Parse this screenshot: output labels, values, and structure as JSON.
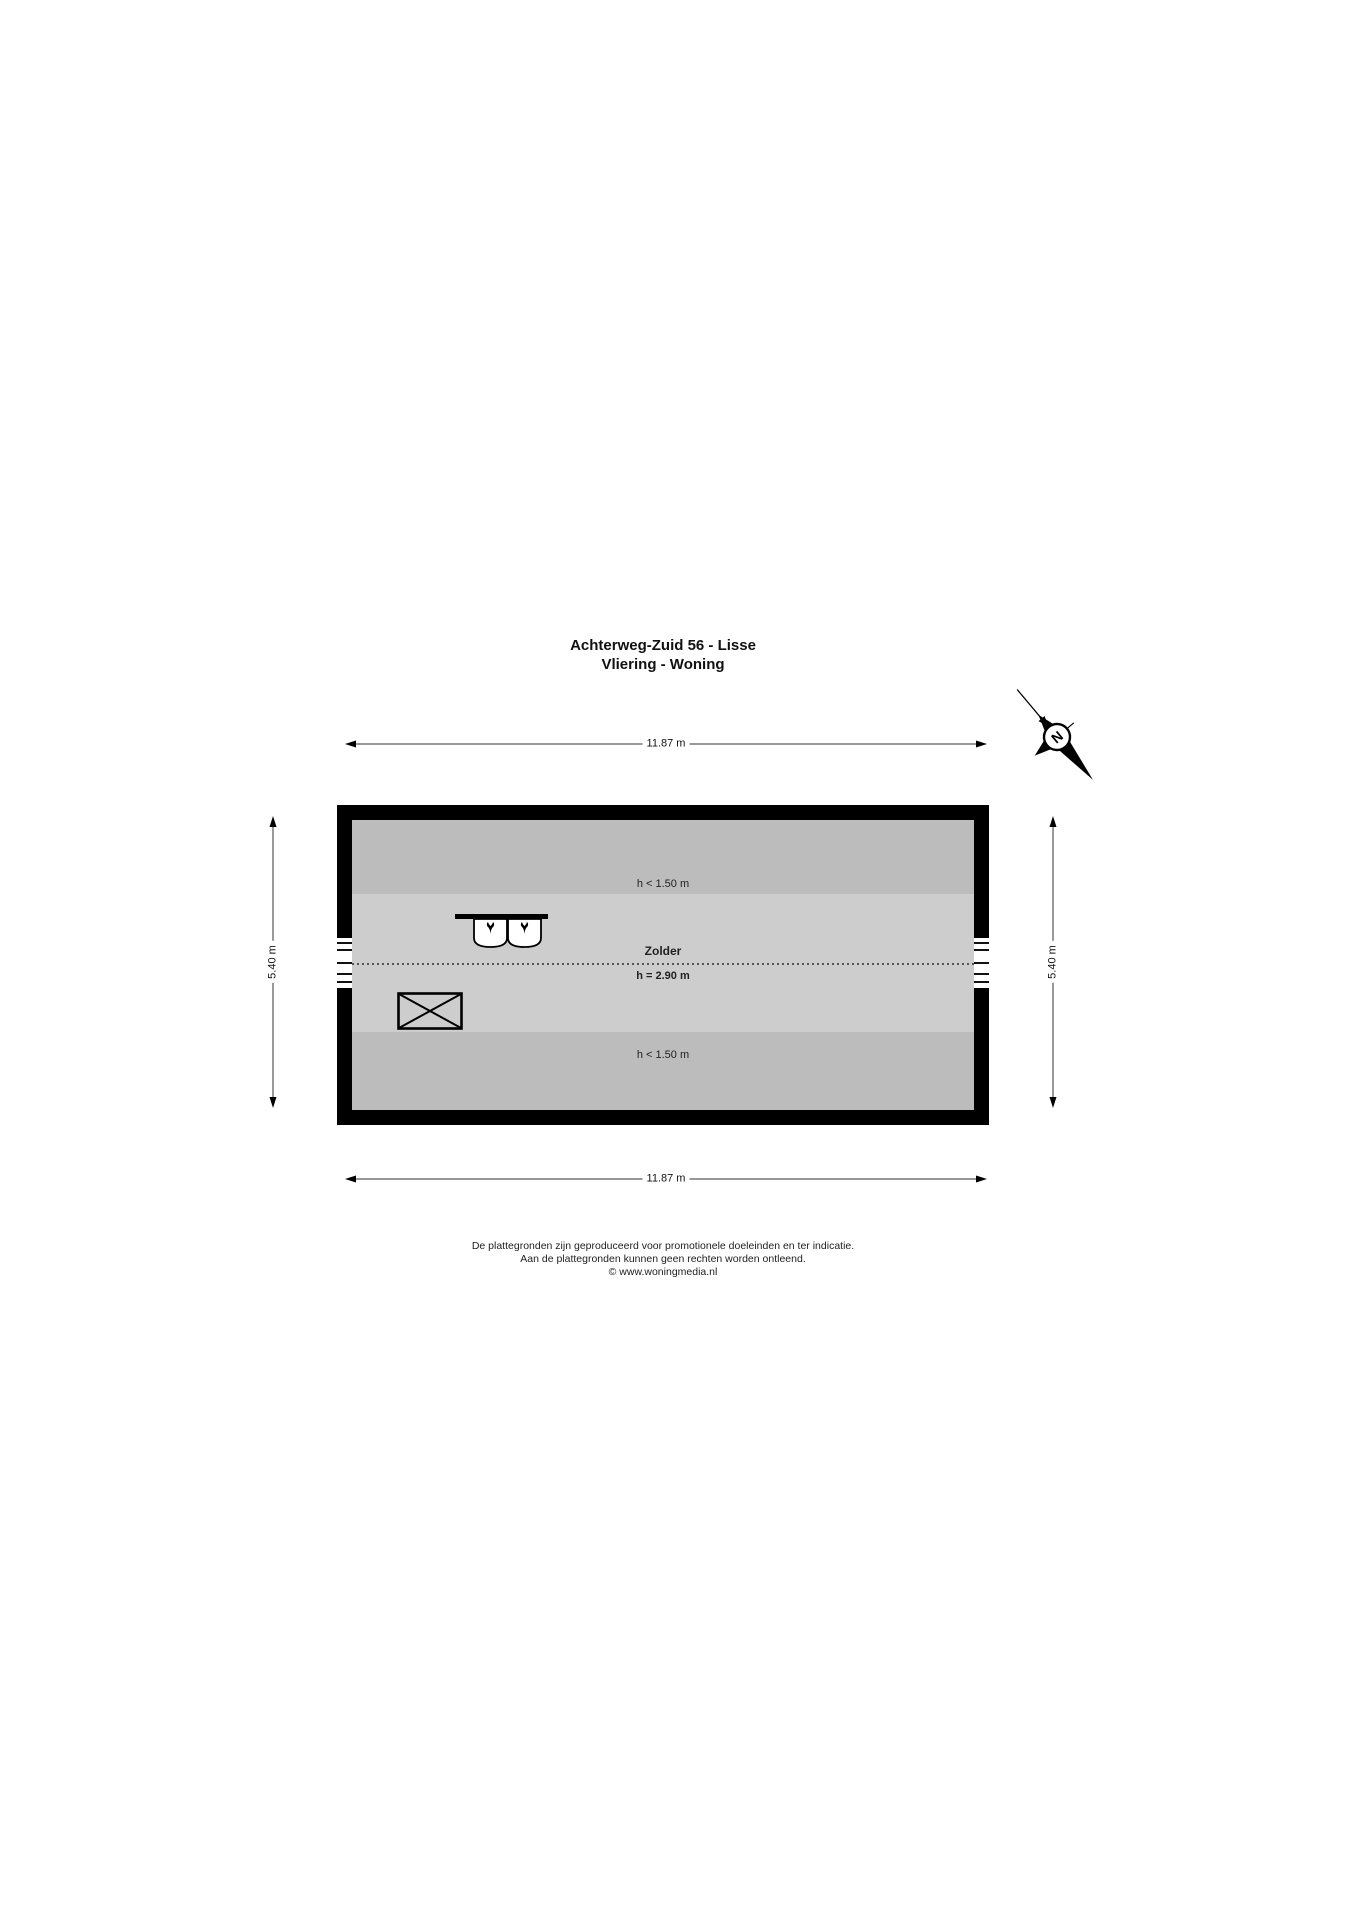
{
  "title": {
    "line1": "Achterweg-Zuid 56 - Lisse",
    "line2": "Vliering - Woning"
  },
  "compass": {
    "label": "N"
  },
  "dimensions": {
    "top": "11.87 m",
    "bottom": "11.87 m",
    "left": "5.40 m",
    "right": "5.40 m"
  },
  "plan": {
    "room": {
      "name": "Zolder",
      "height": "h = 2.90 m"
    },
    "low_height_top": "h < 1.50 m",
    "low_height_bottom": "h < 1.50 m",
    "fixtures": {
      "basins": "double-washbasin",
      "void": "void-opening-crossed"
    }
  },
  "footer": {
    "line1": "De plattegronden zijn geproduceerd voor promotionele doeleinden en ter indicatie.",
    "line2": "Aan de plattegronden kunnen geen rechten worden ontleend.",
    "line3": "© www.woningmedia.nl"
  },
  "colors": {
    "wall": "#000000",
    "band_low": "#bcbcbc",
    "room_floor": "#cdcdcd",
    "background": "#ffffff"
  }
}
